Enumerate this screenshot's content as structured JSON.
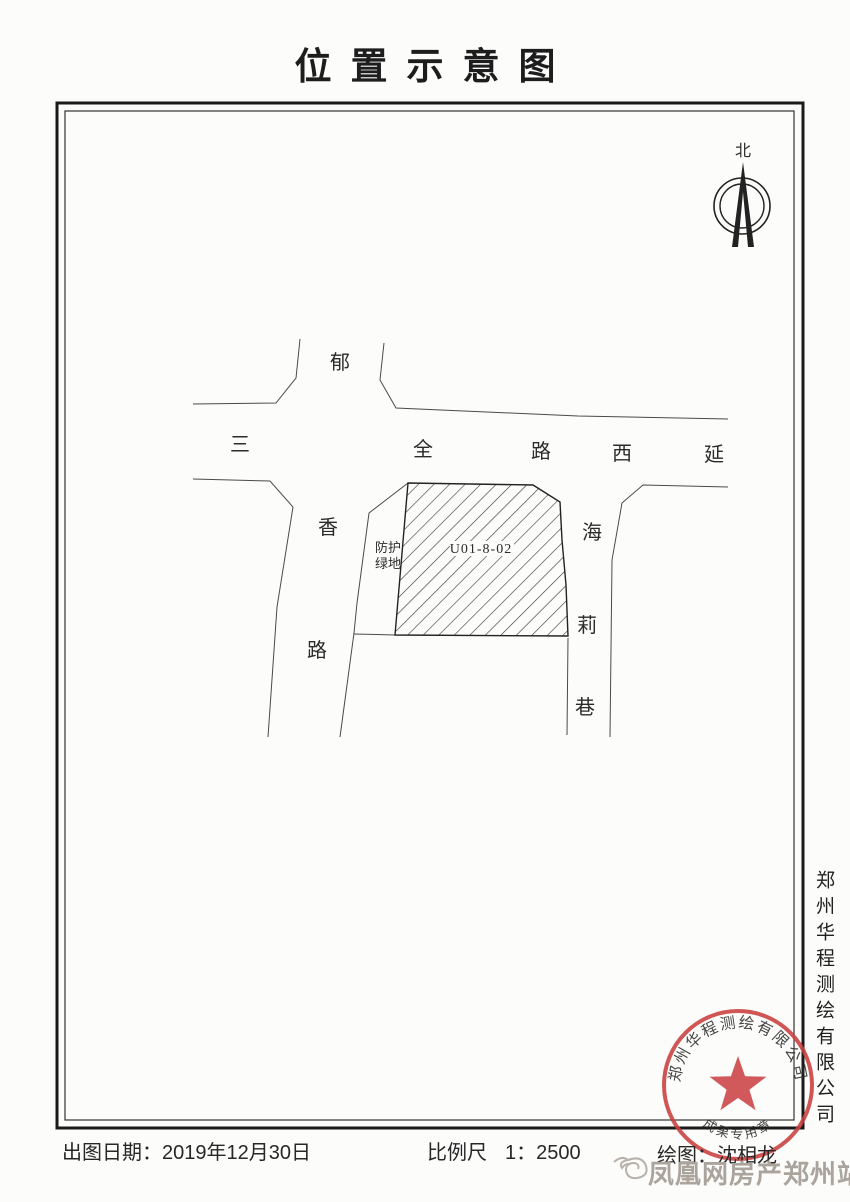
{
  "page": {
    "title": "位置示意图"
  },
  "map": {
    "north_label": "北",
    "roads": {
      "yuxiang_north": "郁",
      "sanquan": [
        "三",
        "全",
        "路",
        "西",
        "延"
      ],
      "yuxiang_south": [
        "香",
        "路"
      ],
      "haili": [
        "海",
        "莉",
        "巷"
      ]
    },
    "green_space": {
      "line1": "防护",
      "line2": "绿地"
    },
    "parcel_label": "U01-8-02"
  },
  "footer": {
    "date_label": "出图日期：",
    "date_value": "2019年12月30日",
    "scale_label": "比例尺",
    "scale_value": "1：2500",
    "drawer_label": "绘图：",
    "drawer_value": "沈相龙"
  },
  "company_name_vertical": "郑州华程测绘有限公司",
  "stamp": {
    "arc_text": "郑州华程测绘有限公司",
    "bottom_text": "成果专用章"
  },
  "watermark": {
    "text": "凤凰网房产郑州站"
  },
  "colors": {
    "ink": "#2b2b2b",
    "map_line": "#4a4a4a",
    "stamp_red": "#c9403f",
    "watermark_gray": "#aba49d"
  }
}
